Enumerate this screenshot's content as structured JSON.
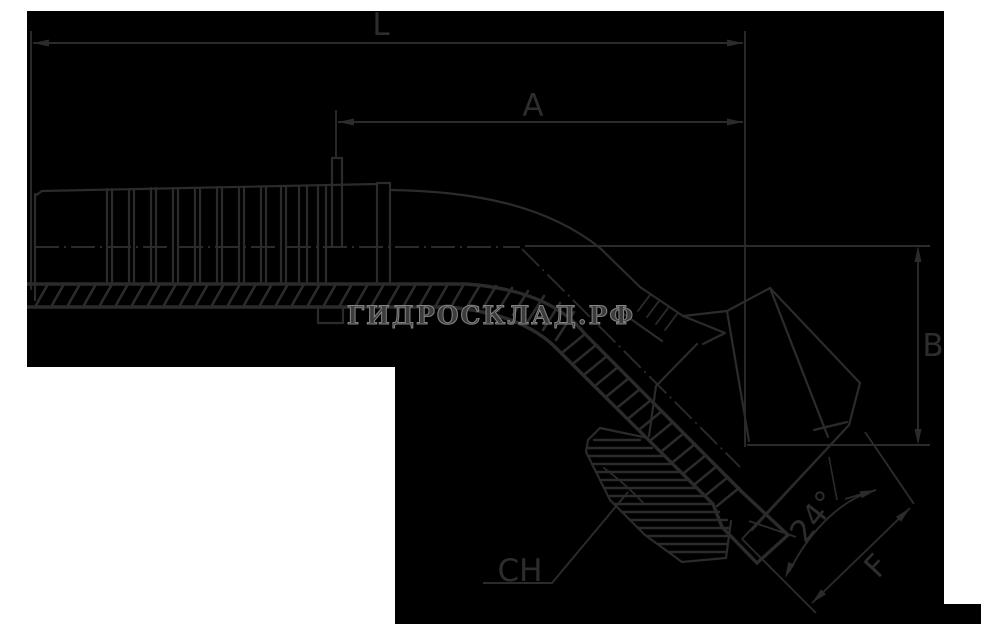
{
  "canvas": {
    "width": 981,
    "height": 624,
    "background_color": "#000000",
    "line_color": "#2b2b2b",
    "frame_color": "#ffffff"
  },
  "labels": {
    "L": "L",
    "A": "A",
    "B": "B",
    "CH": "CH",
    "F": "F",
    "angle": "24°"
  },
  "watermark": {
    "text": "ГИДРОСКЛАД.РФ",
    "fill_color": "#3c3c3c",
    "outline_color": "#848484"
  }
}
